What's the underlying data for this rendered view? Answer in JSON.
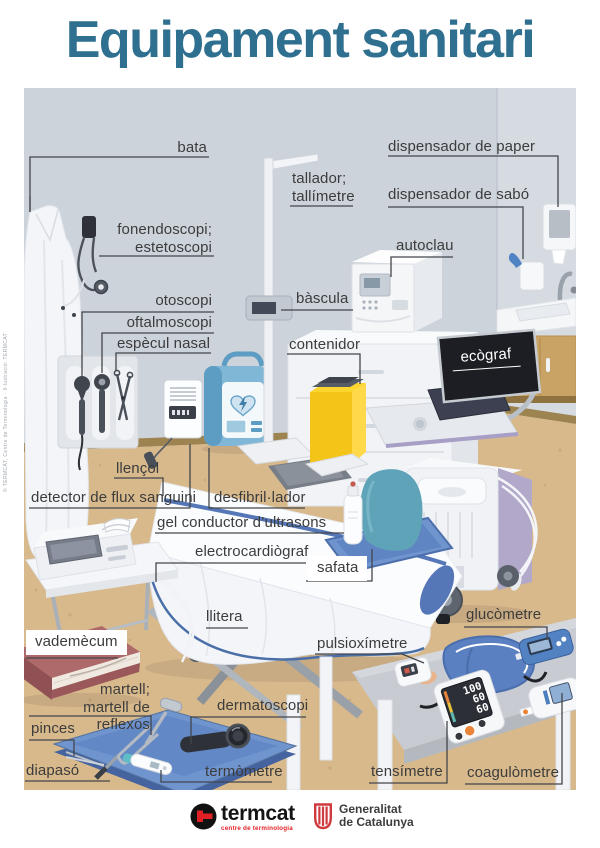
{
  "title": "Equipament sanitari",
  "labels": {
    "bata": "bata",
    "dispensador_paper": "dispensador de paper",
    "tallador": "tallador;\ntallímetre",
    "dispensador_sabo": "dispensador de sabó",
    "fonendoscopi": "fonendoscopi;\nestetoscopi",
    "autoclau": "autoclau",
    "otoscopi": "otoscopi",
    "bascula": "bàscula",
    "oftalmoscopi": "oftalmoscopi",
    "especul_nasal": "espècul nasal",
    "contenidor": "contenidor",
    "ecograf": "ecògraf",
    "llencol": "llençol",
    "detector_flux": "detector de flux sanguini",
    "desfibrillador": "desfibril·lador",
    "gel_ultrasons": "gel conductor d’ultrasons",
    "electrocardiograf": "electrocardiògraf",
    "safata": "safata",
    "llitera": "llitera",
    "glucometre": "glucòmetre",
    "vademecum": "vademècum",
    "pulsioximetre": "pulsioxímetre",
    "martell": "martell;\nmartell de reflexos",
    "dermatoscopi": "dermatoscopi",
    "pinces": "pinces",
    "diapaso": "diapasó",
    "termometre": "termòmetre",
    "tensimetre": "tensímetre",
    "coagulometre": "coagulòmetre"
  },
  "tensimeter_display": {
    "systolic": "100",
    "diastolic": "60",
    "pulse": "60"
  },
  "footer": {
    "termcat_name": "termcat",
    "termcat_subtitle": "centre de terminologia",
    "generalitat_line1": "Generalitat",
    "generalitat_line2": "de Catalunya"
  },
  "credit_vertical": "© TERMCAT, Centre de Terminologia · Il·lustració: TERMCAT",
  "colors": {
    "title_teal": "#2f6f8f",
    "label_text": "#3c3c3c",
    "termcat_red": "#e31f26",
    "generalitat_red": "#cf3a3f",
    "container_yellow": "#f5c418",
    "tray_blue": "#7094ce",
    "defib_blue": "#80b7d7",
    "wall_grey": "#cdd3db",
    "floor_tan": "#d8b98c"
  }
}
